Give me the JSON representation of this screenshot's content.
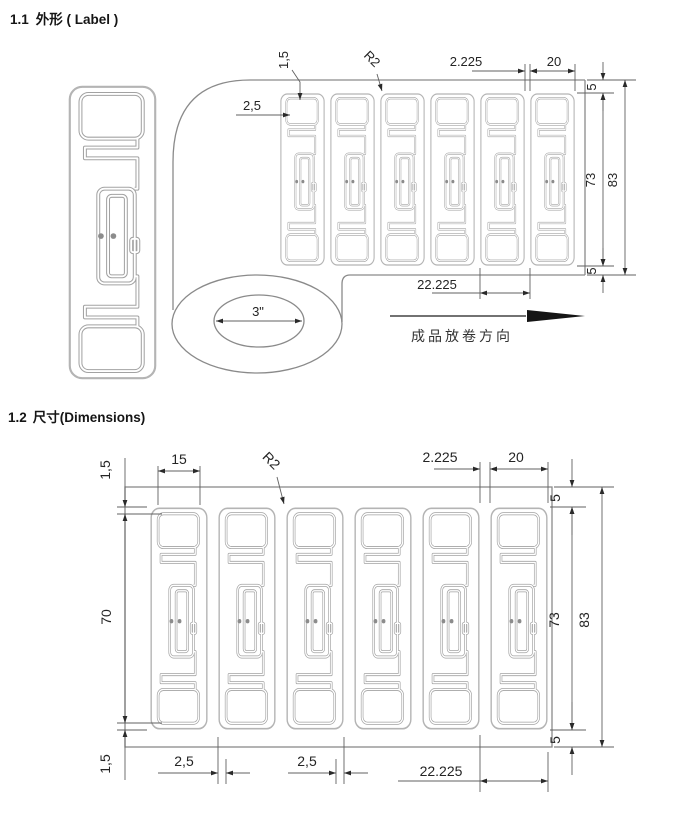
{
  "sections": {
    "s1": {
      "number": "1.1",
      "title": "外形 ( Label )"
    },
    "s2": {
      "number": "1.2",
      "title": "尺寸(Dimensions)"
    }
  },
  "fig1": {
    "core": "3\"",
    "unwind": "成品放卷方向",
    "dims": {
      "m15": "1,5",
      "m25": "2,5",
      "r": "R2",
      "gap": "2.225",
      "w": "20",
      "e5t": "5",
      "h73": "73",
      "w83": "83",
      "e5b": "5",
      "pitch": "22.225"
    }
  },
  "fig2": {
    "dims": {
      "m15t": "1,5",
      "b15": "15",
      "r": "R2",
      "gap": "2.225",
      "w20": "20",
      "e5t": "5",
      "a70": "70",
      "h73": "73",
      "w83": "83",
      "e5b": "5",
      "m15b": "1,5",
      "m25a": "2,5",
      "m25b": "2,5",
      "pitch": "22.225"
    }
  }
}
